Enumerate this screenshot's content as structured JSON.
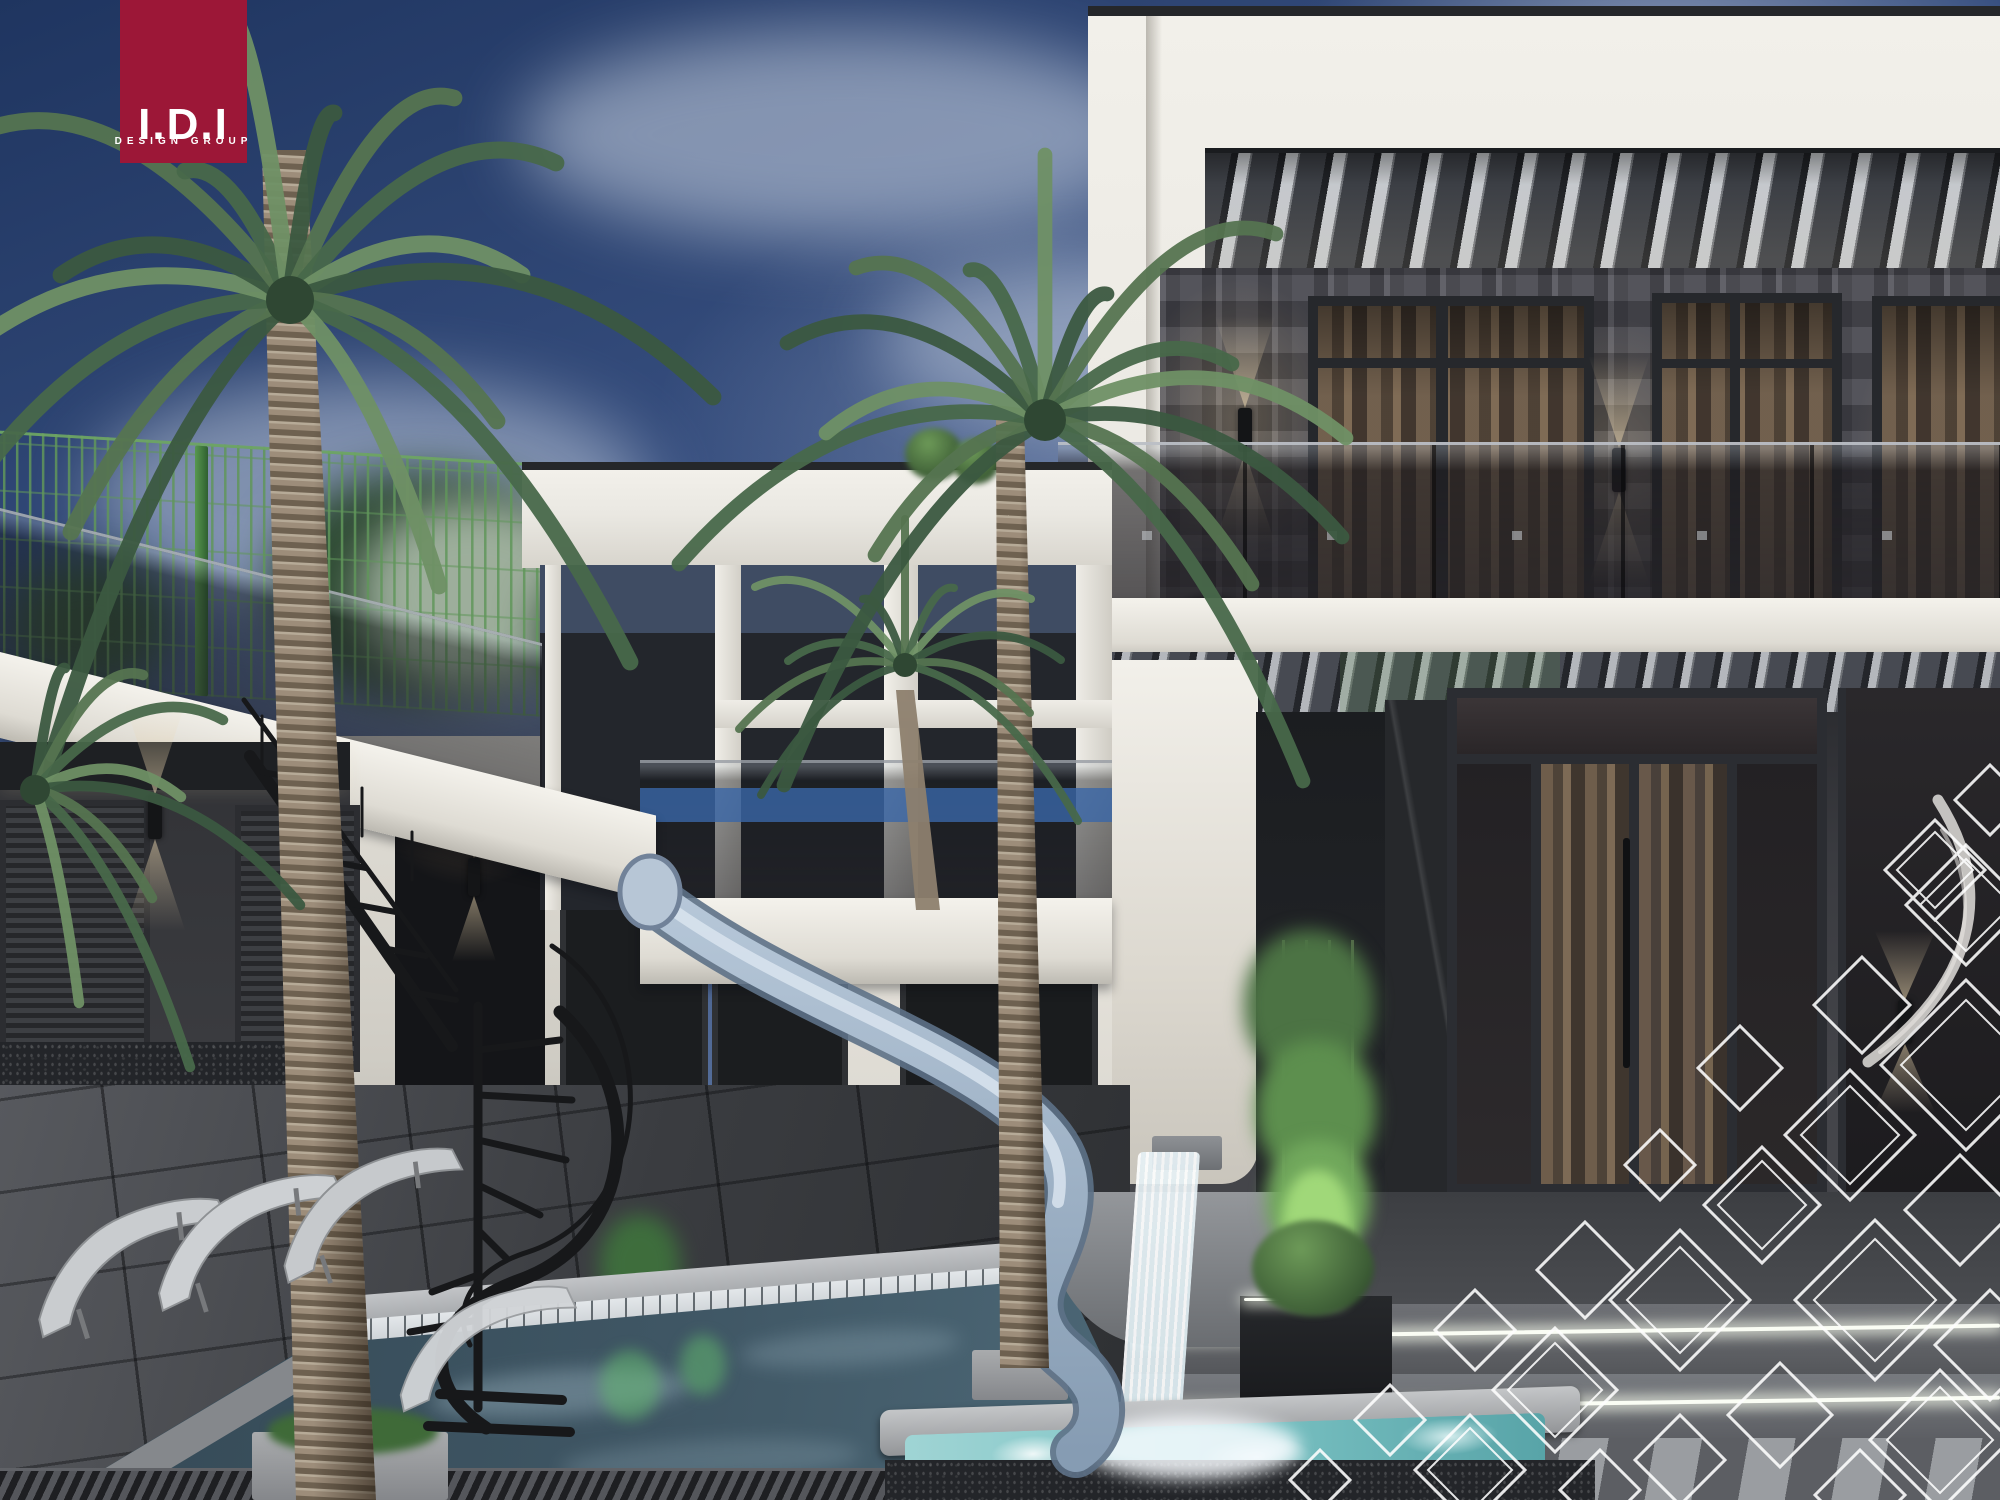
{
  "logo": {
    "title": "I.D.I",
    "subtitle": "DESIGN GROUP"
  },
  "palette": {
    "brand": "#9c1737",
    "brand_text": "#ffffff",
    "sky_top": "#1f3560",
    "sky_mid": "#3a5283",
    "sky_low": "#7d92b4",
    "cloud": "#cdd7e6",
    "wall_white": "#eae8e2",
    "wall_bright": "#f2f0ea",
    "wall_dim": "#d9d6ce",
    "wall_dark": "#45464c",
    "wall_darker": "#2e3035",
    "frame_dark": "#26282c",
    "curtain": "#7b6854",
    "glass_dark": "#232225",
    "blue_accent": "#3a66a8",
    "pergola_slat": "#34363b",
    "pergola_gap": "#c0c3c7",
    "pool_water": "#3f5664",
    "pool_deep": "#2f434f",
    "tile_light": "#ccd1d5",
    "coping": "#a8abae",
    "spa_water": "#7cc3c4",
    "deck": "#5b5d62",
    "deck_dark": "#2e3033",
    "base_speckle": "#232529",
    "slide": "#9db3c9",
    "slide_light": "#d9e4ee",
    "slide_dark": "#5d7187",
    "palm_green": "#557450",
    "palm_dark": "#3b5840",
    "trunk": "#9d8d7a",
    "trunk_dark": "#6e6150",
    "fence_green": "#4a8a46",
    "led": "#fafdf4",
    "glow_warm": "#e8d2aa",
    "stair_black": "#17181a",
    "lounger": "#c9cccf",
    "diamond_white": "#ffffff"
  }
}
